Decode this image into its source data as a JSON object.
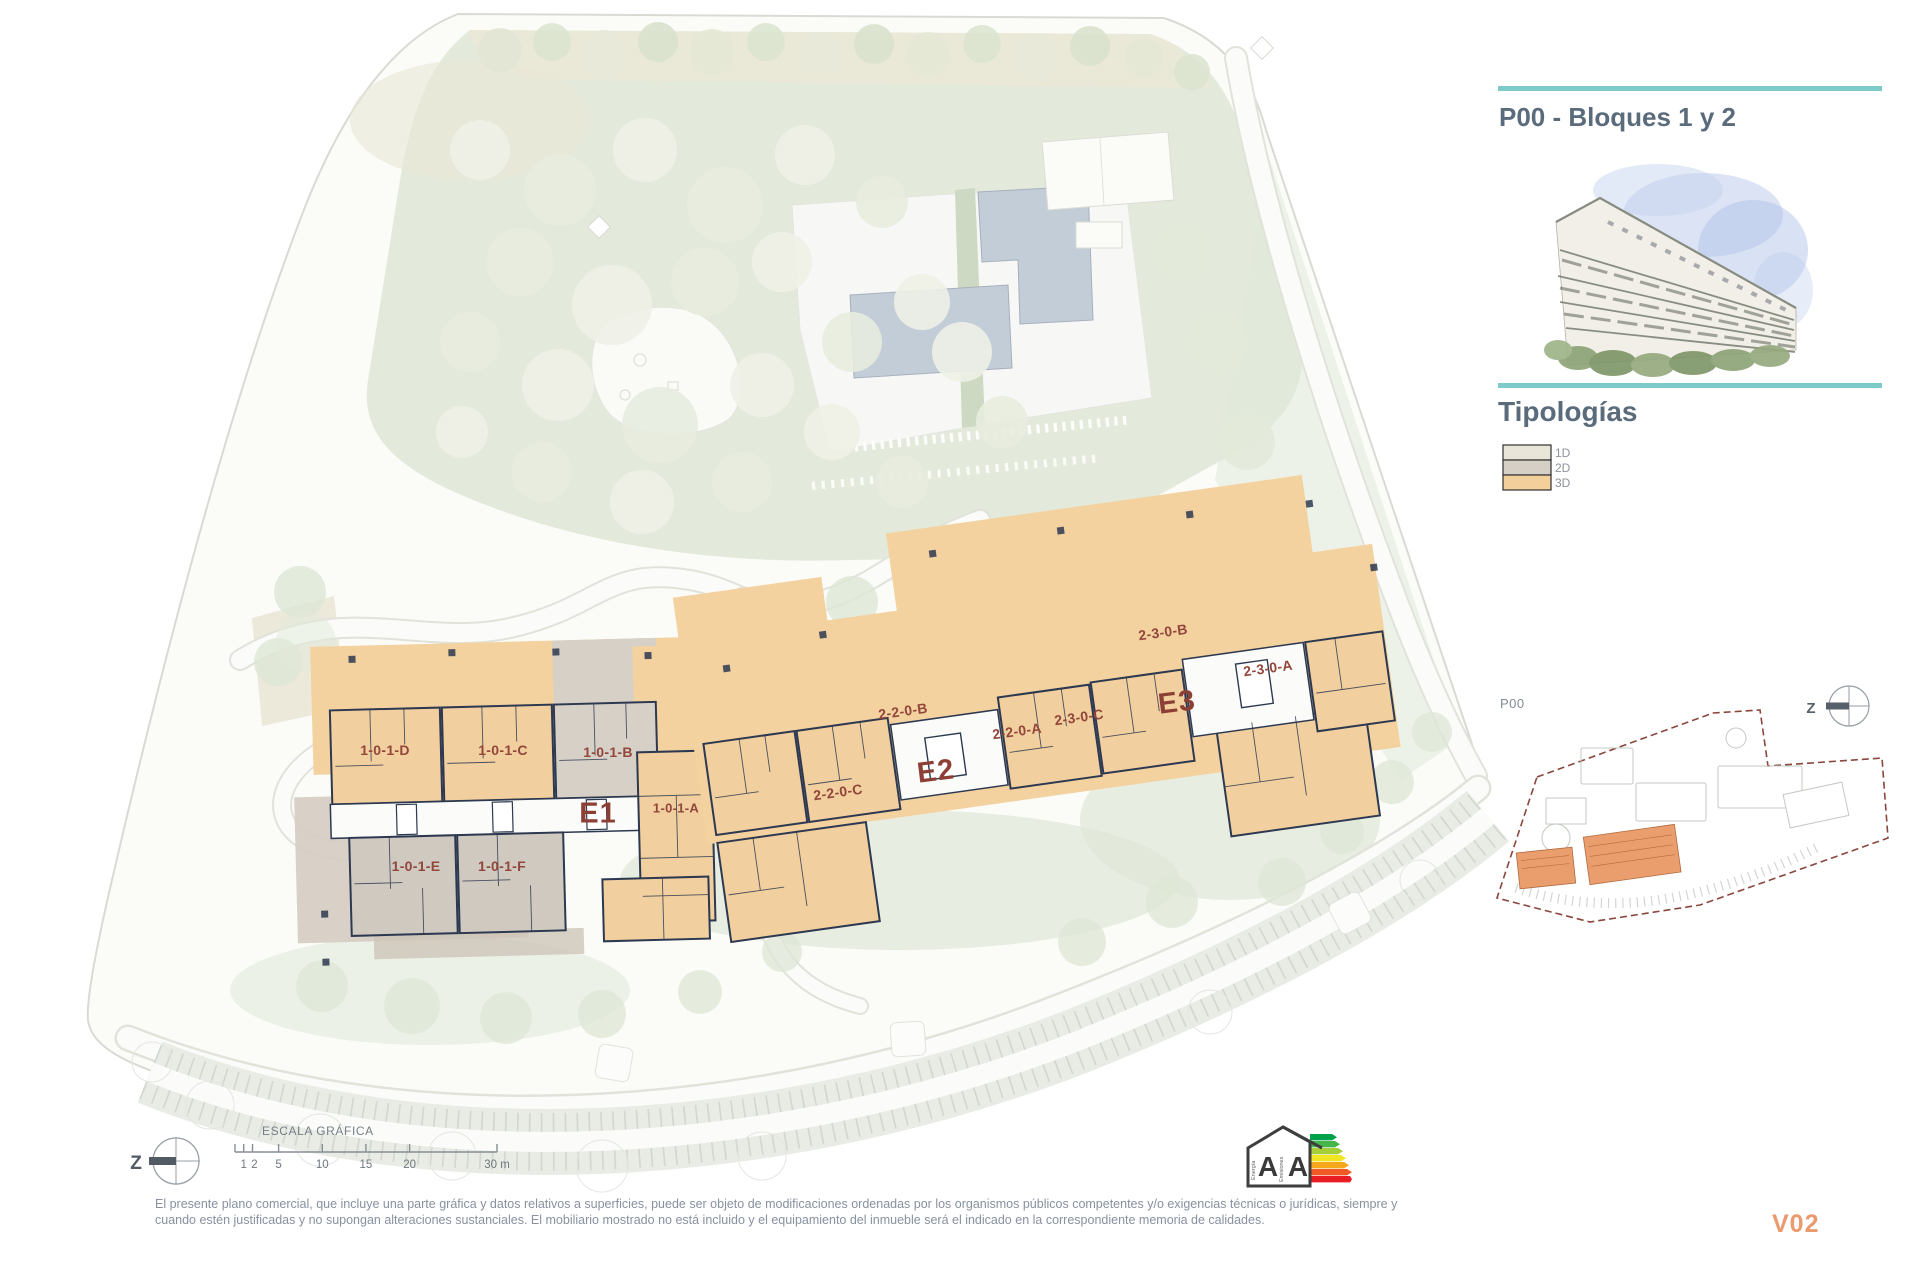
{
  "sidebar": {
    "title": "P00 - Bloques 1 y 2",
    "tipologias_heading": "Tipologías",
    "legend": {
      "d1": "1D",
      "d2": "2D",
      "d3": "3D"
    },
    "keyplan_label": "P00",
    "version": "V02"
  },
  "compass": {
    "letter": "Z"
  },
  "plan": {
    "block_e1": "E1",
    "block_e2": "E2",
    "block_e3": "E3",
    "units": {
      "u1d": "1-0-1-D",
      "u1c": "1-0-1-C",
      "u1b": "1-0-1-B",
      "u1a": "1-0-1-A",
      "u1e": "1-0-1-E",
      "u1f": "1-0-1-F",
      "u22a": "2-2-0-A",
      "u22b": "2-2-0-B",
      "u22c": "2-2-0-C",
      "u23a": "2-3-0-A",
      "u23b": "2-3-0-B",
      "u23c": "2-3-0-C"
    }
  },
  "scalebar": {
    "title": "ESCALA GRÁFICA",
    "n1": "1",
    "n2": "2",
    "n5": "5",
    "n10": "10",
    "n15": "15",
    "n20": "20",
    "n30": "30 m"
  },
  "energy_label": {
    "letter_energy": "A",
    "letter_emissions": "A",
    "word_energy": "Energía",
    "word_emissions": "Emisiones"
  },
  "footer": {
    "line1": "El presente plano comercial, que incluye una parte gráfica y datos relativos a superficies, puede ser objeto de modificaciones ordenadas por los organismos públicos competentes y/o exigencias técnicas o jurídicas, siempre y",
    "line2": "cuando estén justificadas y no supongan alteraciones sustanciales. El mobiliario mostrado no está incluido y el equipamiento del inmueble será el indicado en la correspondiente memoria de calidades."
  },
  "colors": {
    "accent_teal": "#7ecac8",
    "heading_slate": "#5a6b7c",
    "version_orange": "#ea9a6e",
    "unit_label_maroon": "#92463c",
    "typ_1d": "#e9e5d8",
    "typ_2d": "#d6cfc5",
    "typ_3d": "#f2cf9b"
  }
}
